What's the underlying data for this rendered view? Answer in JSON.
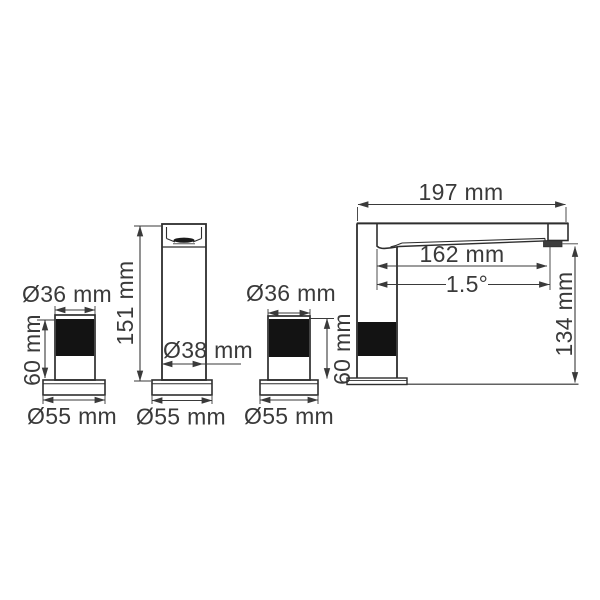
{
  "figures": {
    "left_handle": {
      "top_diameter": "Ø36 mm",
      "height": "60 mm",
      "base_diameter": "Ø55 mm"
    },
    "spout_front": {
      "height": "151 mm",
      "body_diameter": "Ø38 mm",
      "base_diameter": "Ø55 mm"
    },
    "right_handle": {
      "top_diameter": "Ø36 mm",
      "height": "60 mm",
      "base_diameter": "Ø55 mm"
    },
    "spout_side": {
      "overall_length": "197 mm",
      "spout_reach": "162 mm",
      "spout_angle": "1.5°",
      "height_to_outlet": "134 mm"
    }
  },
  "colors": {
    "line": "#2e2e2e",
    "dim": "#3a3a3a",
    "text": "#3a3a3a",
    "black_fill": "#131313",
    "background": "#ffffff"
  }
}
